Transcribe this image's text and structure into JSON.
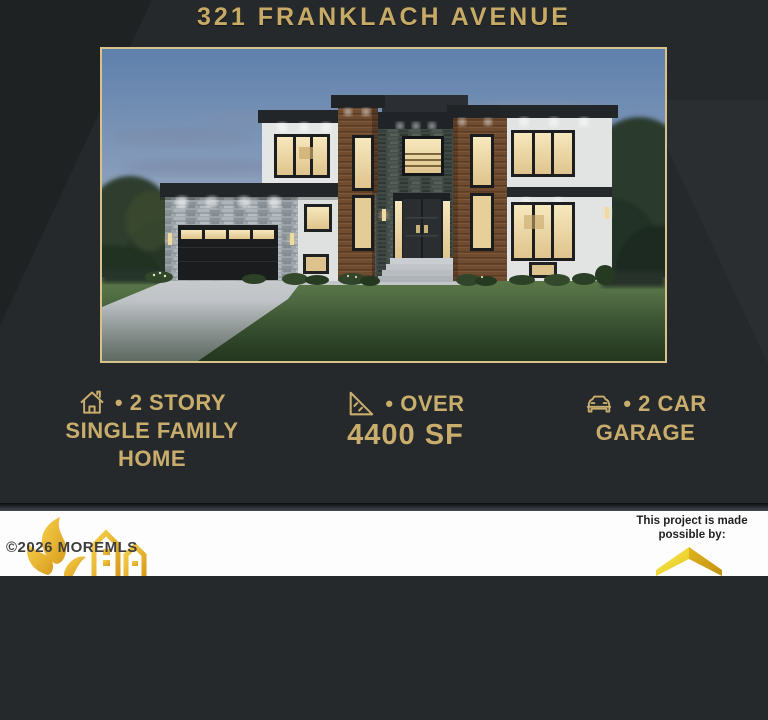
{
  "title": "321 FRANKLACH AVENUE",
  "features": [
    {
      "icon": "house-icon",
      "line1": "• 2 STORY",
      "line2": "SINGLE FAMILY",
      "line3": "HOME"
    },
    {
      "icon": "area-ruler-icon",
      "line1": "• OVER",
      "line2": "4400 SF"
    },
    {
      "icon": "car-icon",
      "line1": "• 2 CAR",
      "line2": "GARAGE"
    }
  ],
  "watermark": {
    "text": "©2026 MOREMLS"
  },
  "sponsor": {
    "line1": "This project is made",
    "line2": "possible by:"
  },
  "photo": {
    "description": "modern two-story single family home rendering at dusk"
  },
  "colors": {
    "background": "#26292b",
    "gold_text": "#c9ad6d",
    "frame_border": "#d8c289",
    "band": "#ffffff",
    "logo_gold": "#e9b92f"
  }
}
